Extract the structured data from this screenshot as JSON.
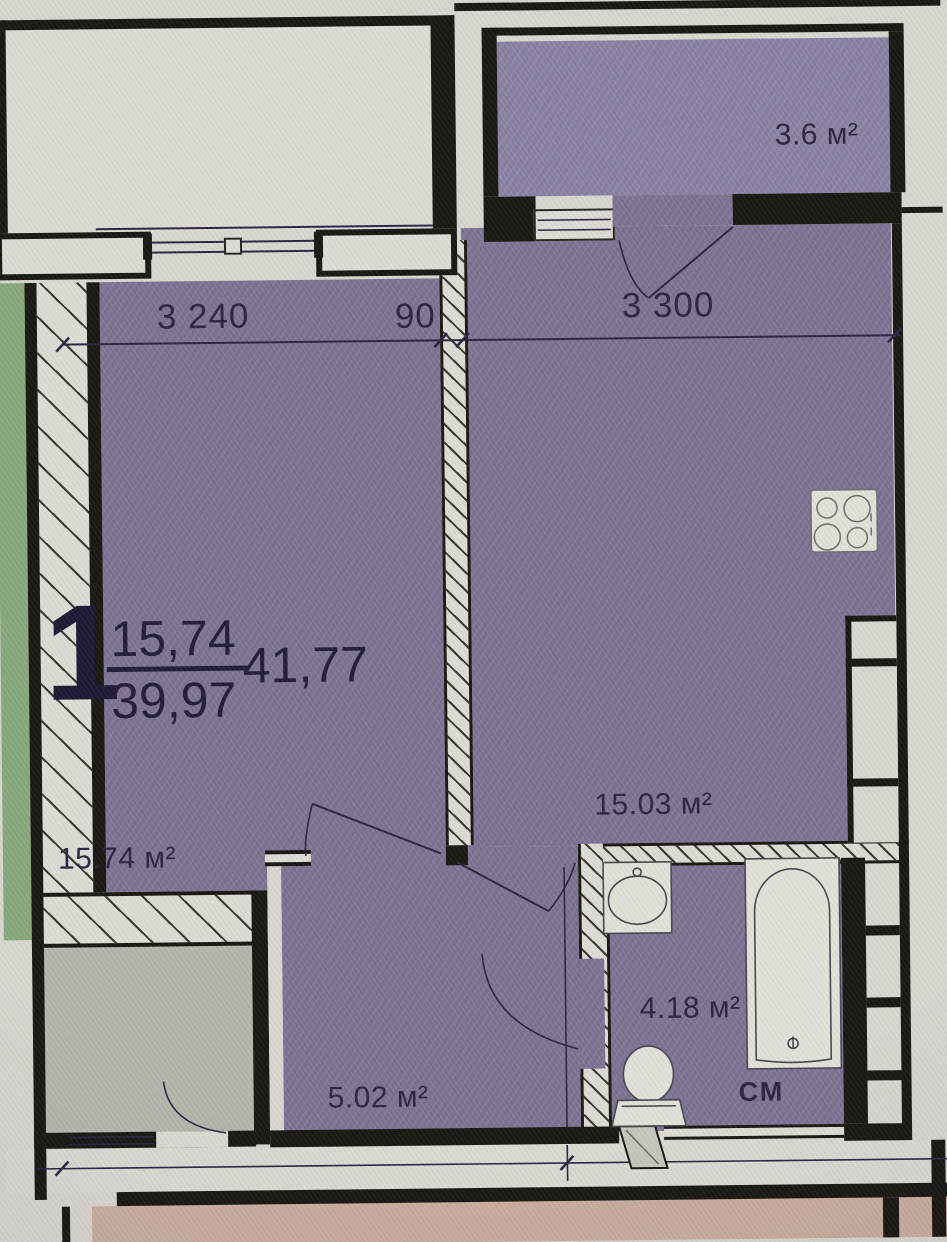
{
  "plan": {
    "apartment_stamp": {
      "number": "1",
      "living_area": "15,74",
      "total_area": "39,97",
      "overall_area": "41,77"
    },
    "dimensions": {
      "left_room_width": "3 240",
      "partition_thickness": "90",
      "kitchen_width": "3 300"
    },
    "rooms": {
      "balcony": {
        "area_label": "3.6 м²"
      },
      "living_room": {
        "area_label": "15.74 м²"
      },
      "kitchen": {
        "area_label": "15.03 м²"
      },
      "hallway": {
        "area_label": "5.02 м²"
      },
      "bathroom": {
        "area_label": "4.18 м²"
      }
    },
    "annotations": {
      "washing_machine": "СМ"
    }
  },
  "colors": {
    "paper": "#d9d6d0",
    "paper-light": "#dedad4",
    "wall": "#1b1814",
    "ink": "#2e2542",
    "room-fill": "#7c7191",
    "balcony-fill": "#8a7fa2",
    "adjacent-green": "#88a87d",
    "adjacent-gray": "#b7b4ad",
    "corridor-pink": "#c9ad9f"
  }
}
